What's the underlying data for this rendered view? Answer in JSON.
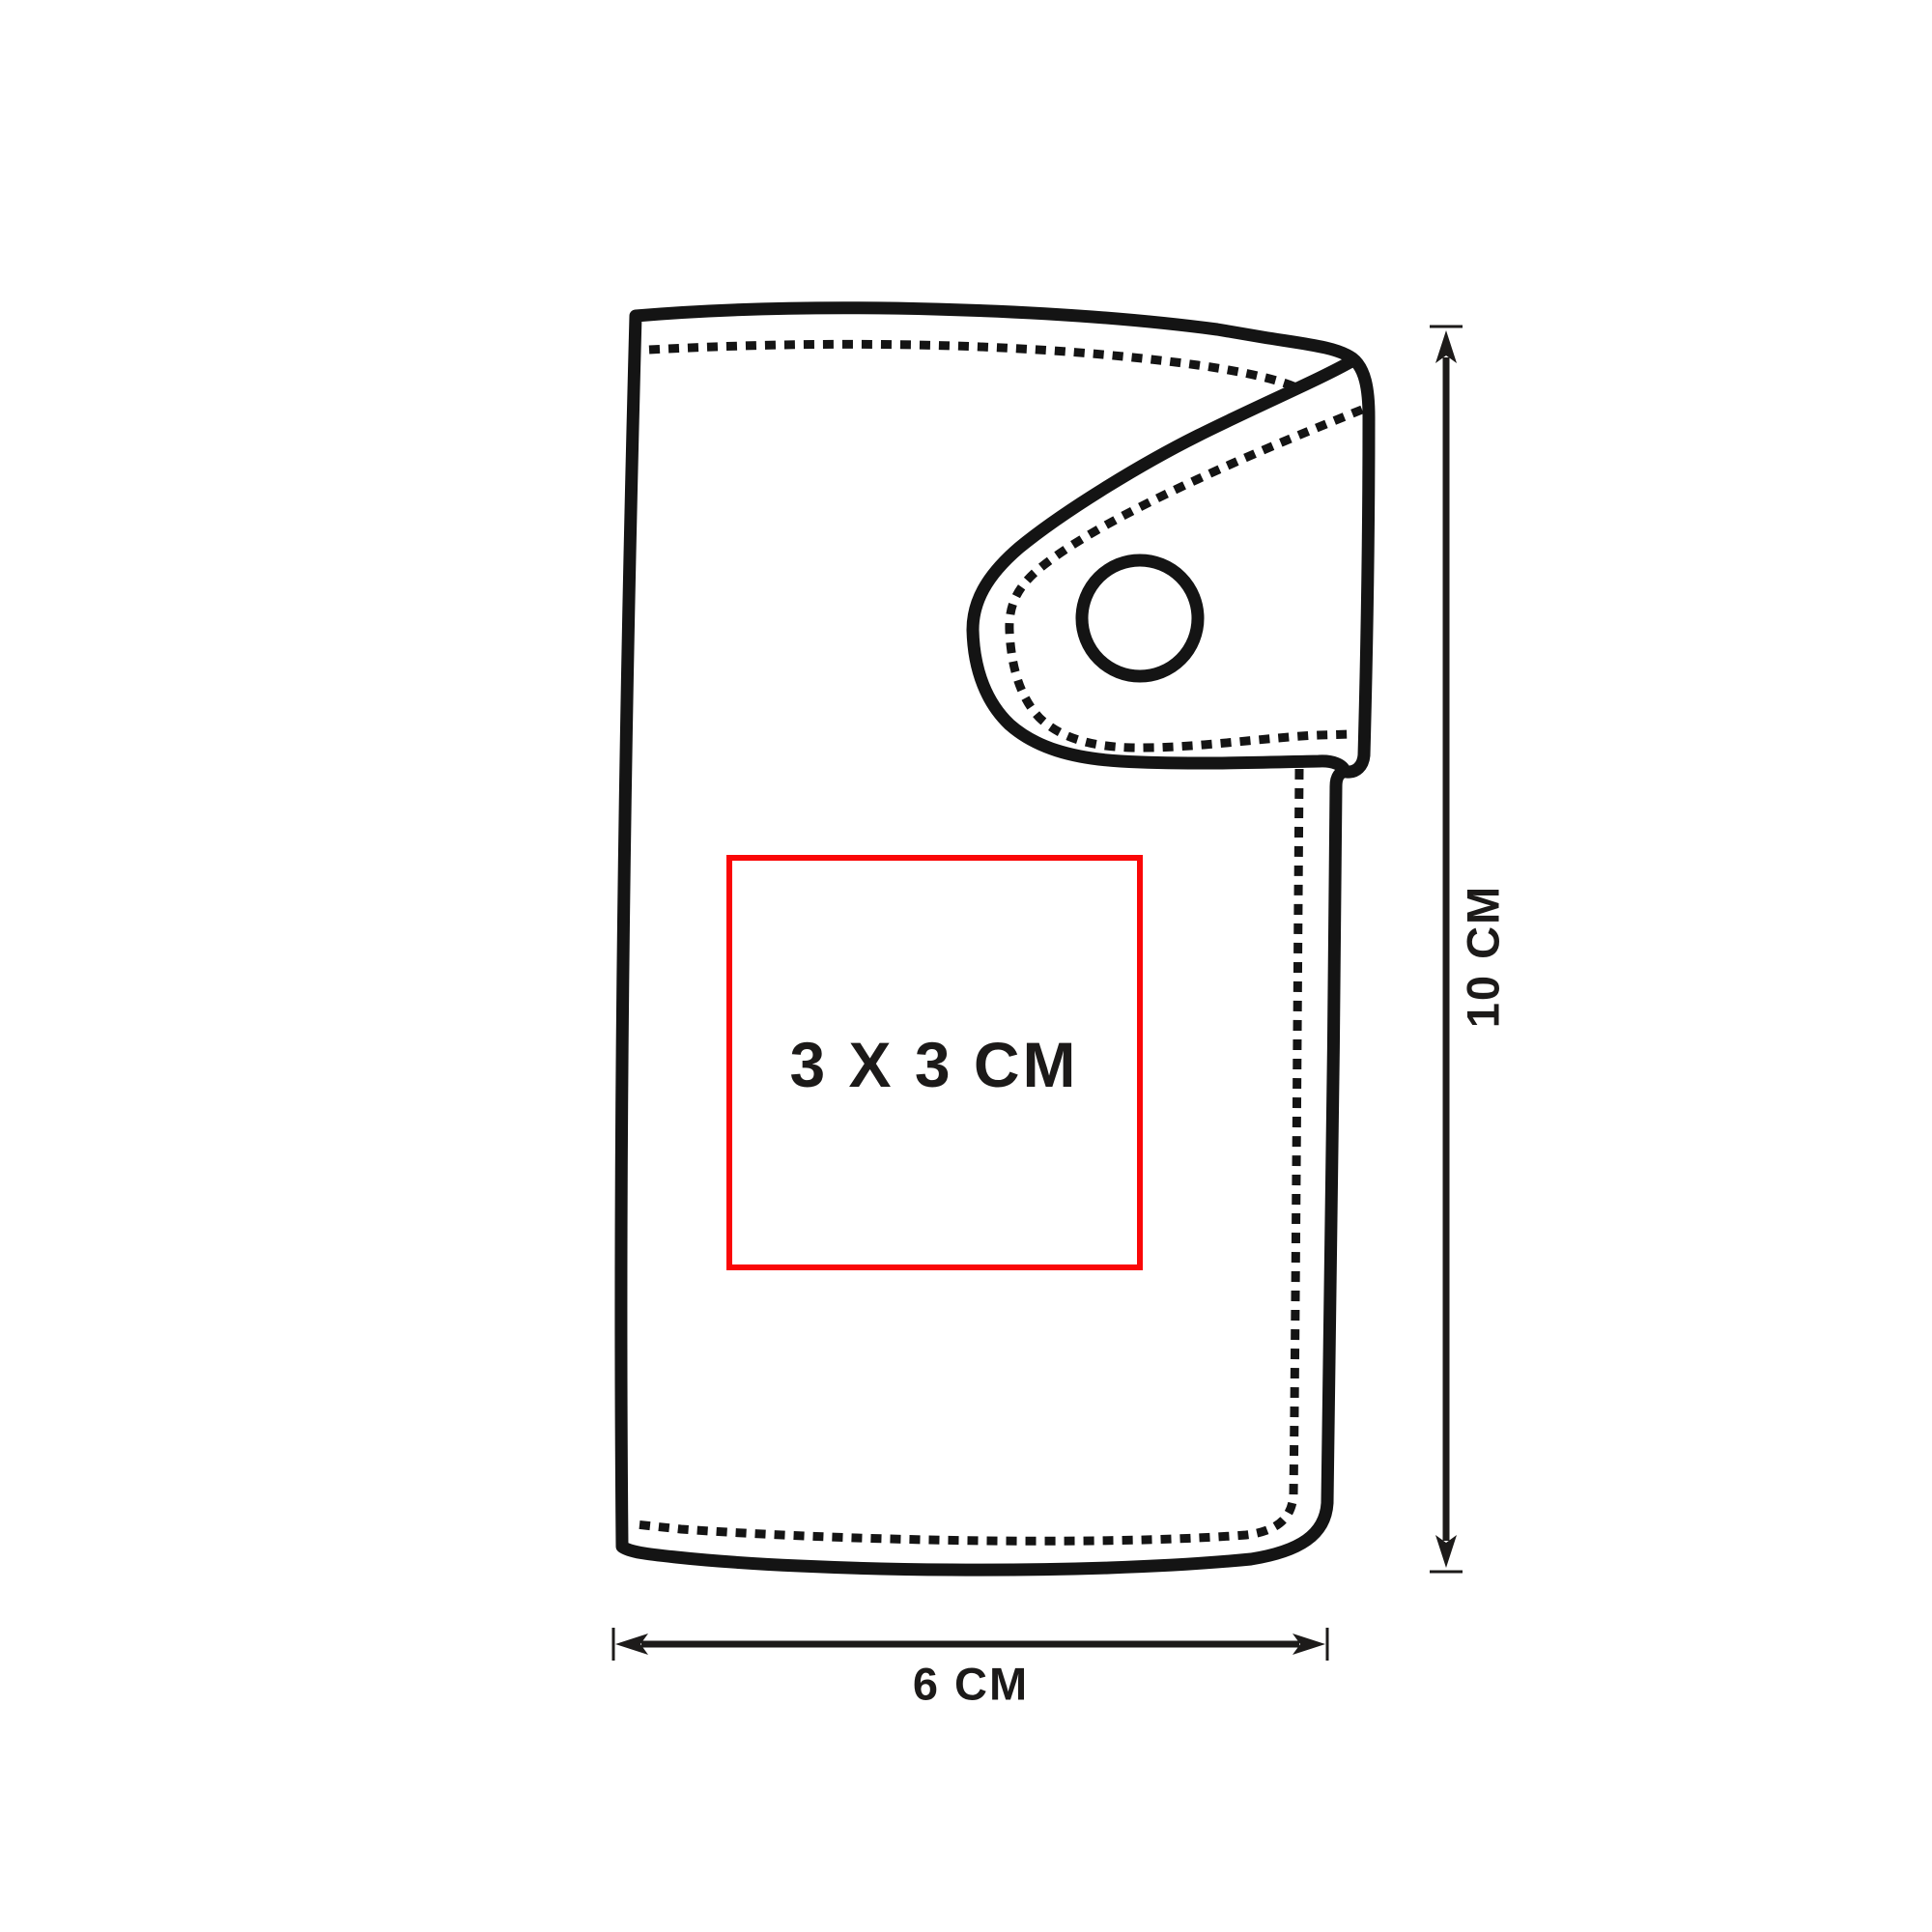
{
  "diagram": {
    "kind": "product imprint-area dimension drawing",
    "object": "snap-button wallet",
    "features": [
      "fold-over-flap",
      "snap-button",
      "stitch-lines"
    ]
  },
  "print_area": {
    "label": "3 X 3 CM",
    "width_cm": 3,
    "height_cm": 3
  },
  "dimensions": {
    "height": {
      "label": "10 CM",
      "value_cm": 10,
      "orientation": "vertical"
    },
    "width": {
      "label": "6 CM",
      "value_cm": 6,
      "orientation": "horizontal"
    }
  },
  "colors": {
    "outline": "#141414",
    "print_area_box": "#fa0707",
    "label_text": "#1c1a19",
    "background": "#ffffff"
  }
}
